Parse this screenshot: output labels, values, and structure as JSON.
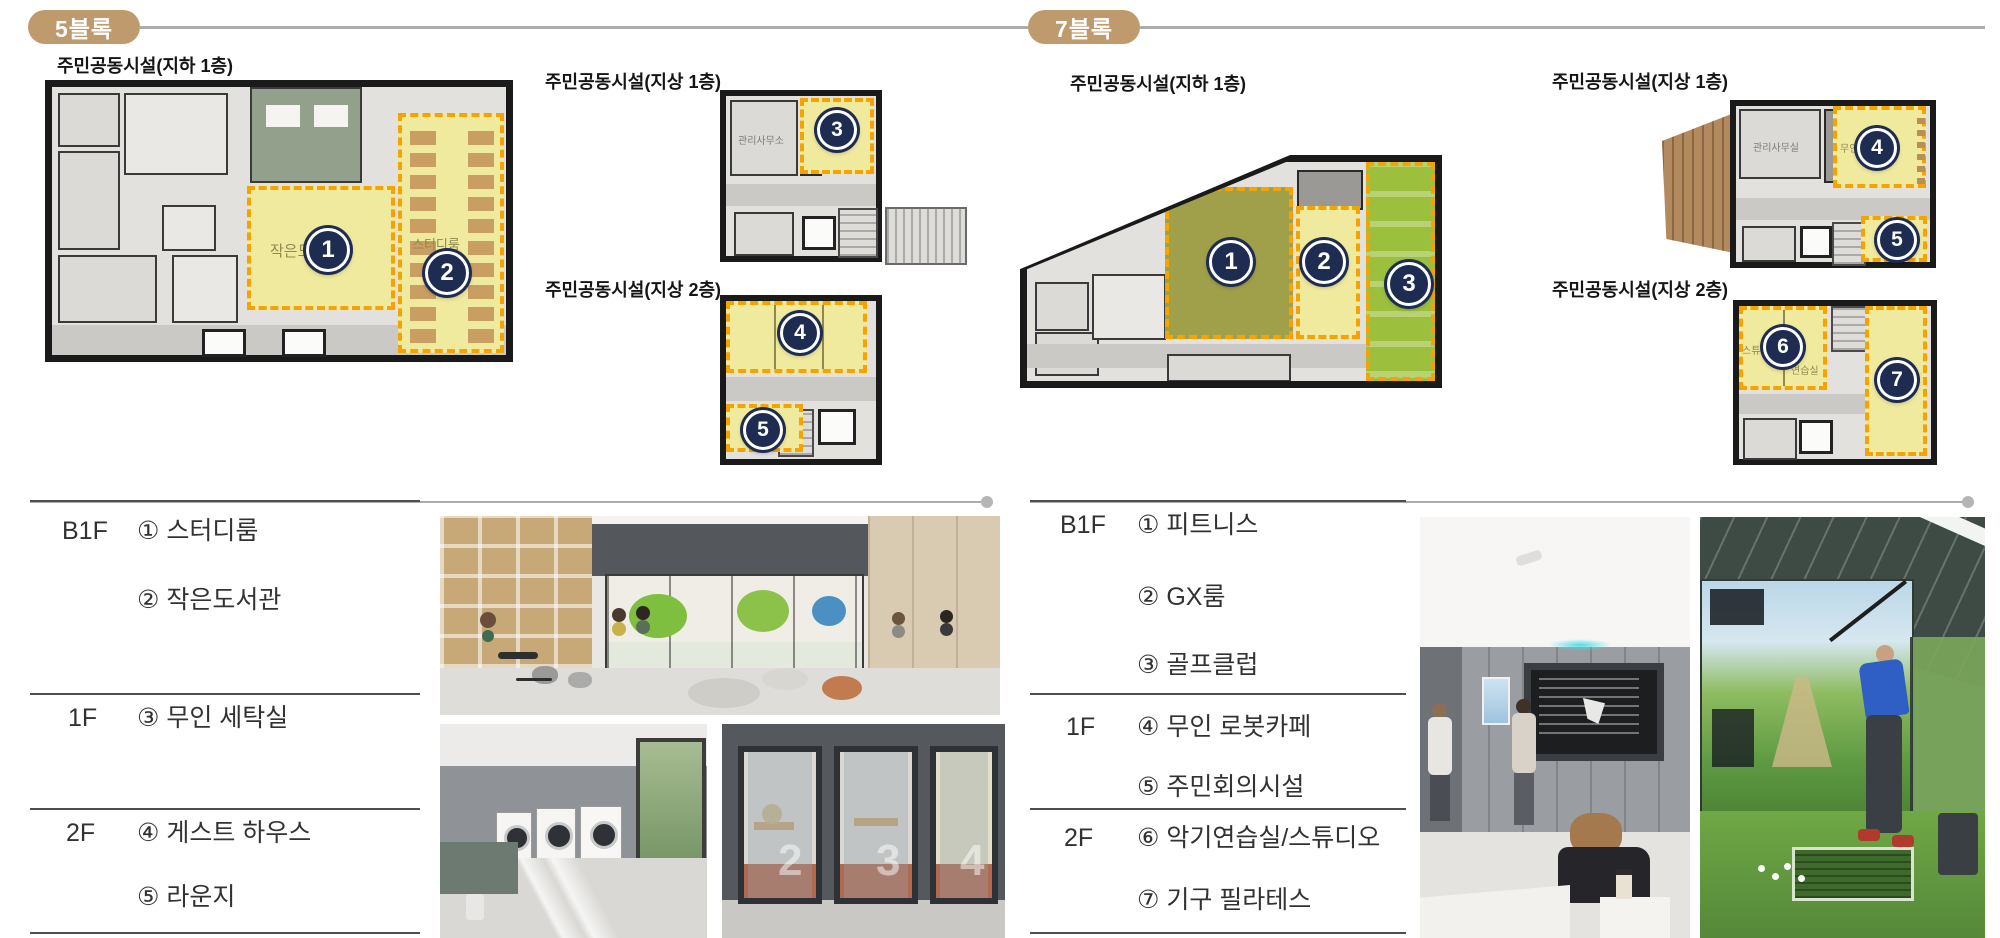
{
  "page": {
    "badge_color": "#BE9A6C",
    "highlight_border_color": "#F5A300",
    "highlight_fill_color": "#F0EA9E",
    "marker_color": "#1D2C50"
  },
  "blocks": [
    {
      "badge": "5블록",
      "plans": [
        {
          "caption": "주민공동시설(지하 1층)",
          "rooms": [
            {
              "marker": "1",
              "label": "작은도서관"
            },
            {
              "marker": "2",
              "label": "스터디룸"
            }
          ]
        },
        {
          "caption": "주민공동시설(지상 1층)",
          "office_label": "관리사무소",
          "rooms": [
            {
              "marker": "3",
              "label": ""
            }
          ]
        },
        {
          "caption": "주민공동시설(지상 2층)",
          "rooms": [
            {
              "marker": "4",
              "label": ""
            },
            {
              "marker": "5",
              "label": ""
            }
          ]
        }
      ],
      "legend": [
        {
          "floor": "B1F",
          "items": [
            "① 스터디룸",
            "② 작은도서관"
          ]
        },
        {
          "floor": "1F",
          "items": [
            "③ 무인 세탁실"
          ]
        },
        {
          "floor": "2F",
          "items": [
            "④ 게스트 하우스",
            "⑤ 라운지"
          ]
        }
      ],
      "booth_numbers": [
        "2",
        "3",
        "4"
      ],
      "photo_names": [
        "lounge-library-render",
        "laundry-room-render",
        "study-booth-render"
      ]
    },
    {
      "badge": "7블록",
      "plans": [
        {
          "caption": "주민공동시설(지하 1층)",
          "rooms": [
            {
              "marker": "1",
              "label": ""
            },
            {
              "marker": "2",
              "label": ""
            },
            {
              "marker": "3",
              "label": ""
            }
          ]
        },
        {
          "caption": "주민공동시설(지상 1층)",
          "office_label": "관리사무실",
          "rooms": [
            {
              "marker": "4",
              "label": "무인 로봇카페"
            },
            {
              "marker": "5",
              "label": ""
            }
          ]
        },
        {
          "caption": "주민공동시설(지상 2층)",
          "practice_label": "연습실",
          "rooms": [
            {
              "marker": "6",
              "label": "스튜디오"
            },
            {
              "marker": "7",
              "label": ""
            }
          ]
        }
      ],
      "legend": [
        {
          "floor": "B1F",
          "items": [
            "① 피트니스",
            "② GX룸",
            "③ 골프클럽"
          ]
        },
        {
          "floor": "1F",
          "items": [
            "④ 무인 로봇카페",
            "⑤ 주민회의시설"
          ]
        },
        {
          "floor": "2F",
          "items": [
            "⑥ 악기연습실/스튜디오",
            "⑦ 기구 필라테스"
          ]
        }
      ],
      "photo_names": [
        "robot-cafe-render",
        "golf-simulator-render"
      ]
    }
  ]
}
